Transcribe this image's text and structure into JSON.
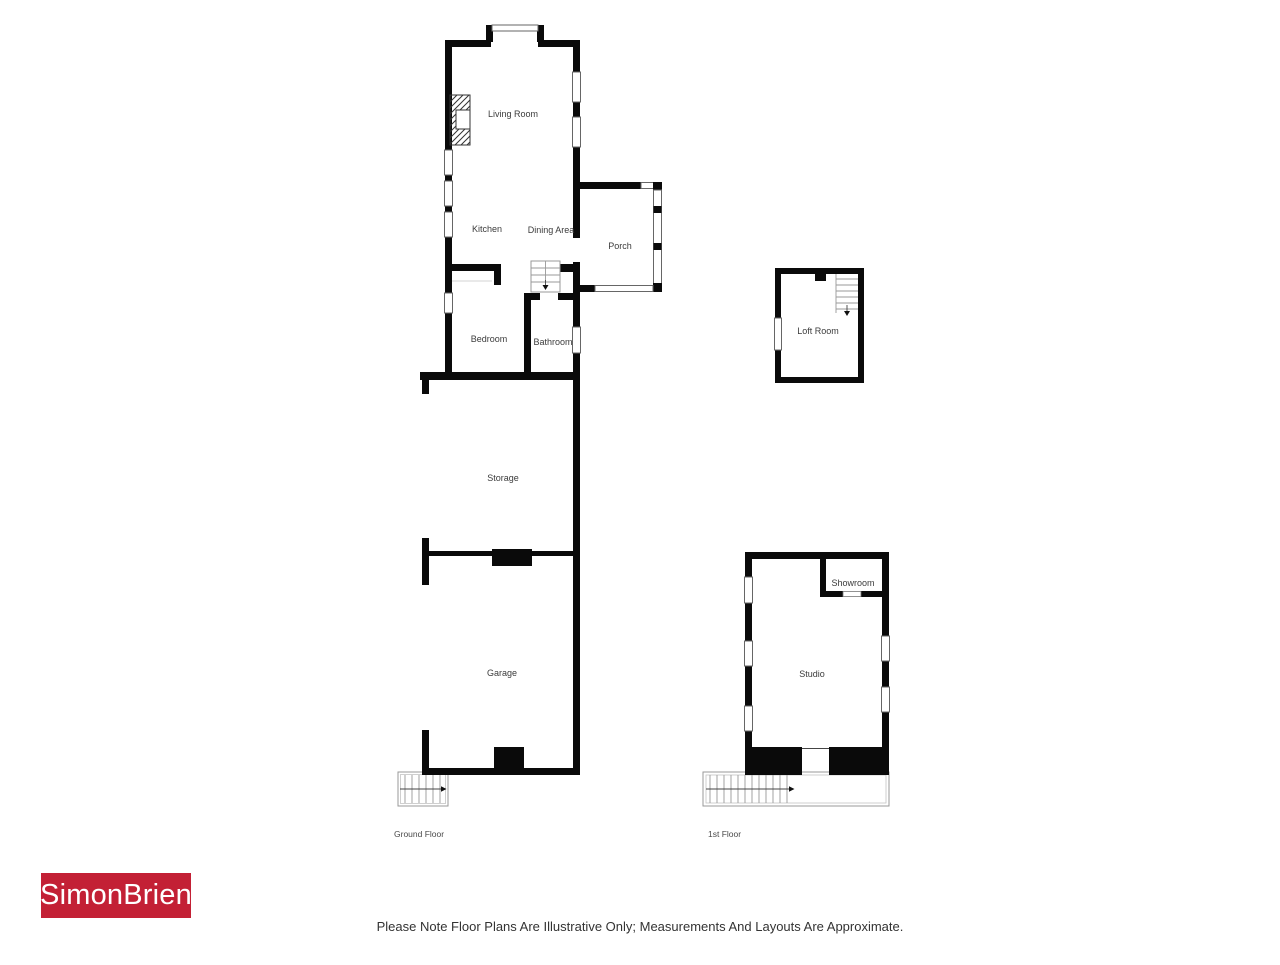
{
  "plan": {
    "floors": {
      "ground_floor_label": "Ground Floor",
      "first_floor_label": "1st Floor"
    },
    "rooms": {
      "living_room": "Living Room",
      "kitchen": "Kitchen",
      "dining_area": "Dining Area",
      "porch": "Porch",
      "bedroom": "Bedroom",
      "bathroom": "Bathroom",
      "loft_room": "Loft Room",
      "storage": "Storage",
      "garage": "Garage",
      "showroom": "Showroom",
      "studio": "Studio"
    },
    "colors": {
      "wall": "#0a0a0a",
      "room_label": "#3b3b3b",
      "window_outline": "#666666"
    }
  },
  "branding": {
    "logo_text": "SimonBrien",
    "logo_background": "#c32035",
    "logo_text_color": "#ffffff"
  },
  "disclaimer": "Please Note Floor Plans Are Illustrative Only; Measurements And Layouts Are Approximate."
}
